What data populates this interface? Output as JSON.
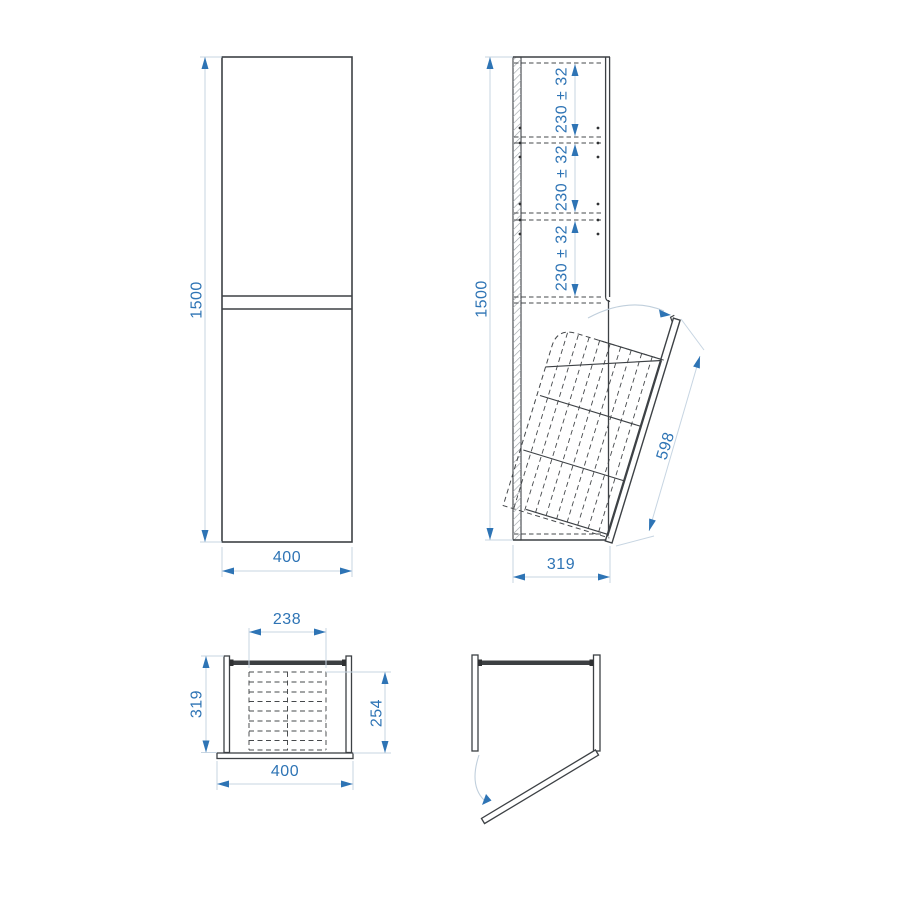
{
  "drawing": {
    "views": {
      "front": {
        "height": "1500",
        "width": "400"
      },
      "side": {
        "height": "1500",
        "depth": "319",
        "door_length": "598",
        "shelf_spacings": [
          "230 ± 32",
          "230 ± 32",
          "230 ± 32"
        ]
      },
      "top_closed": {
        "basket_width": "238",
        "depth": "319",
        "basket_depth": "254",
        "width": "400"
      },
      "top_open": {}
    },
    "colors": {
      "dimension_blue": "#2e74b5",
      "line_dark": "#3d4145",
      "line_light": "#c7d5e2",
      "dash_gray": "#45484b"
    }
  }
}
